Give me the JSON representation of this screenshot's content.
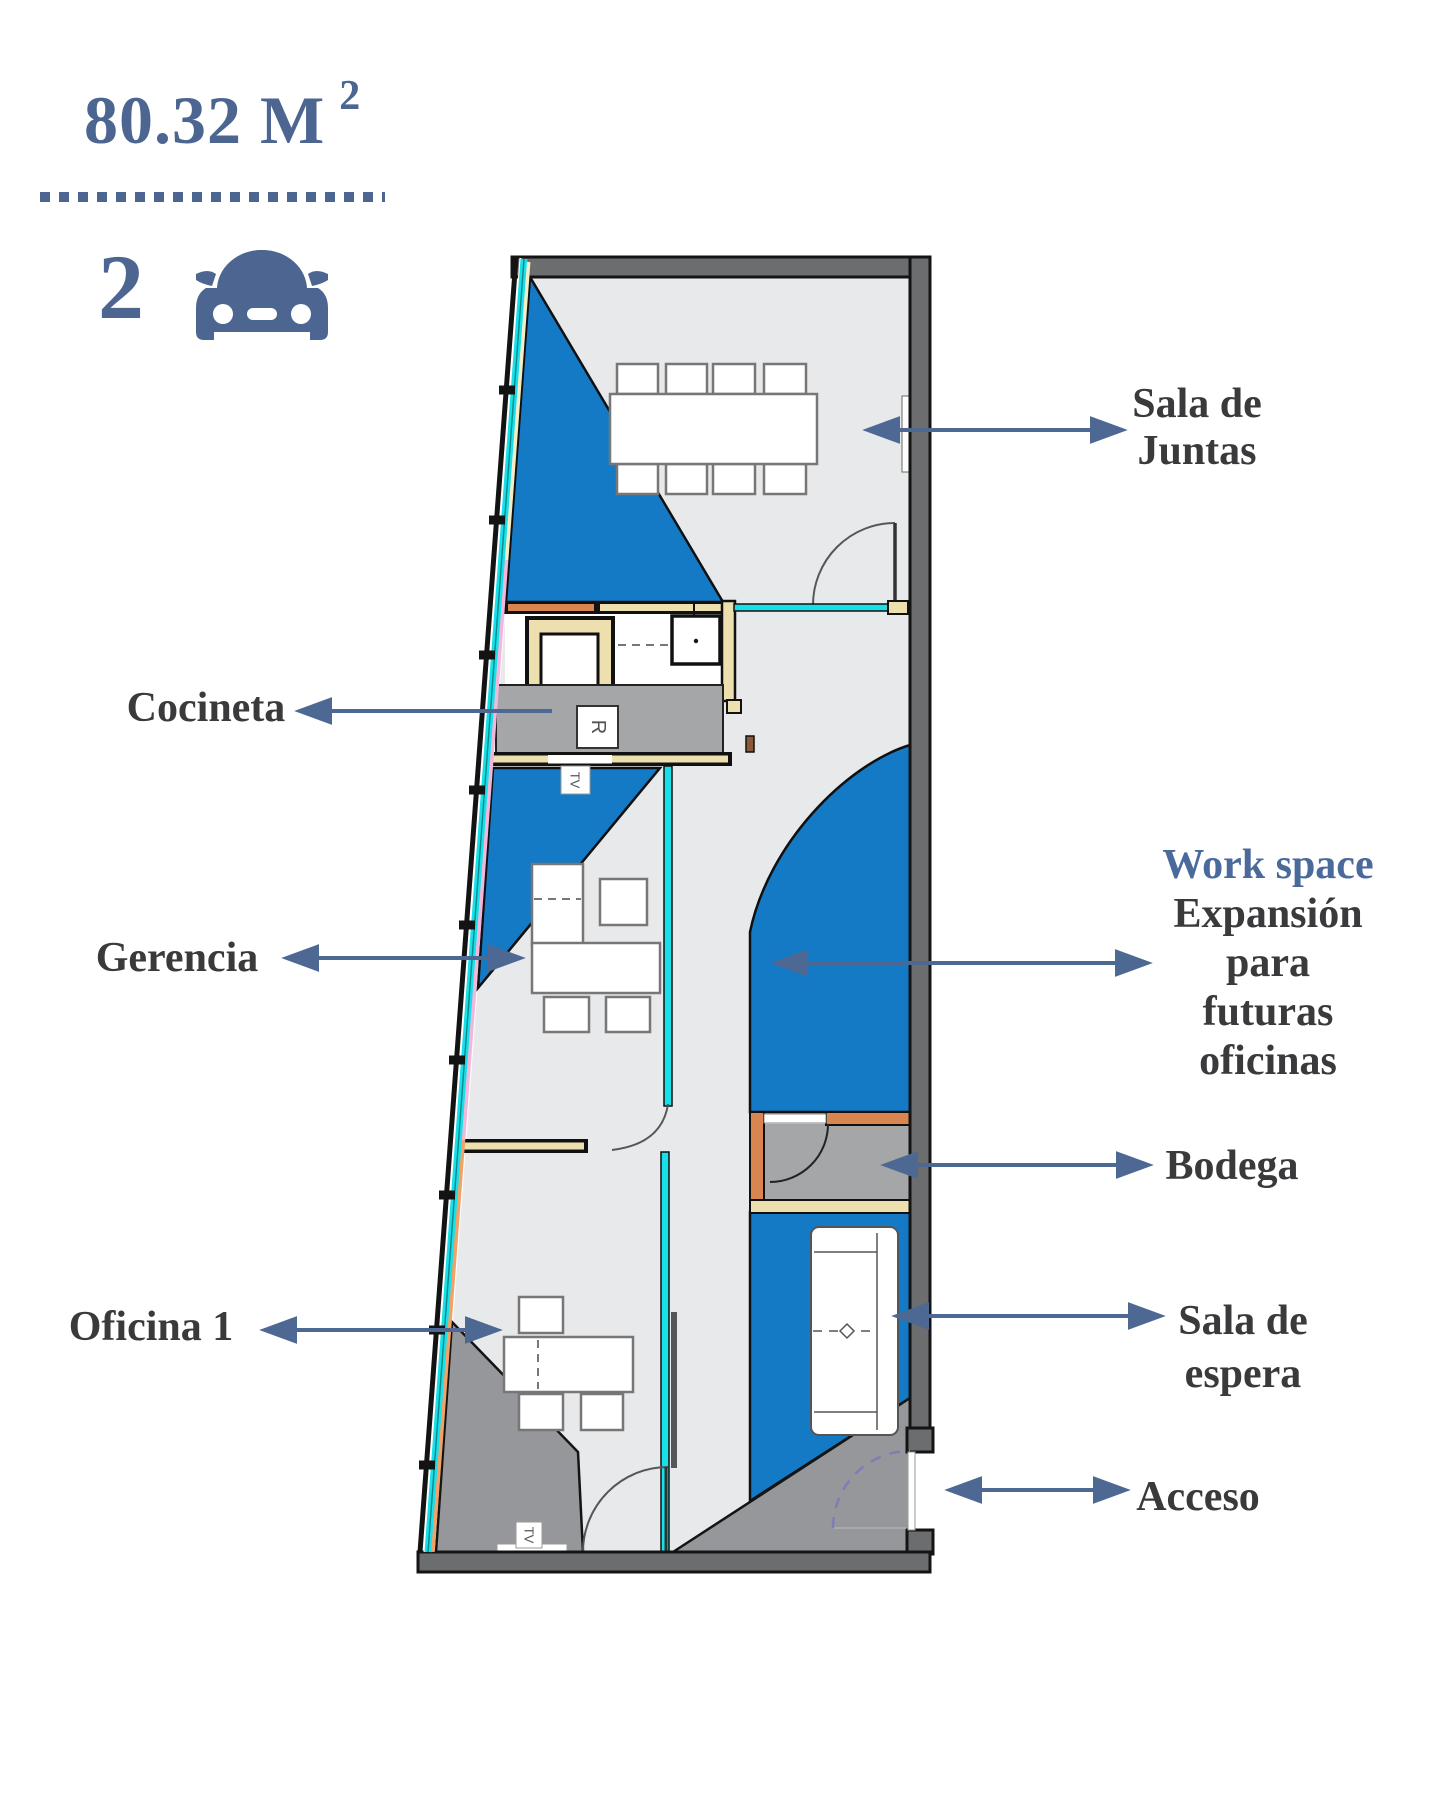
{
  "header": {
    "area_value": "80.32 M",
    "area_superscript": "2",
    "parking_count": "2",
    "parking_icon": "car-front-icon"
  },
  "colors": {
    "accent_slate_blue": "#4d6691",
    "work_space_title_blue": "#4a6a9c",
    "label_dark": "#3a3a3c",
    "plan_blue": "#147ac6",
    "glass_cyan": "#19dfe8",
    "wall_gray": "#6c6d6f",
    "floor_light_gray": "#e8e9ea",
    "floor_mid_gray": "#a5a6a8",
    "shadow_gray": "#96979a",
    "wood_tan": "#eedfae",
    "orange_wall": "#d8854f"
  },
  "plan": {
    "fixtures": {
      "refrigerator_label": "R",
      "tv_label_kitchen": "TV",
      "tv_label_office": "TV"
    }
  },
  "labels": {
    "sala_de_juntas": {
      "line1": "Sala de",
      "line2": "Juntas"
    },
    "cocineta": {
      "line1": "Cocineta"
    },
    "gerencia": {
      "line1": "Gerencia"
    },
    "oficina_1": {
      "line1": "Oficina 1"
    },
    "work_space": {
      "title": "Work space",
      "line1": "Expansión",
      "line2": "para",
      "line3": "futuras",
      "line4": "oficinas"
    },
    "bodega": {
      "line1": "Bodega"
    },
    "sala_de_espera": {
      "line1": "Sala de",
      "line2": "espera"
    },
    "acceso": {
      "line1": "Acceso"
    }
  }
}
